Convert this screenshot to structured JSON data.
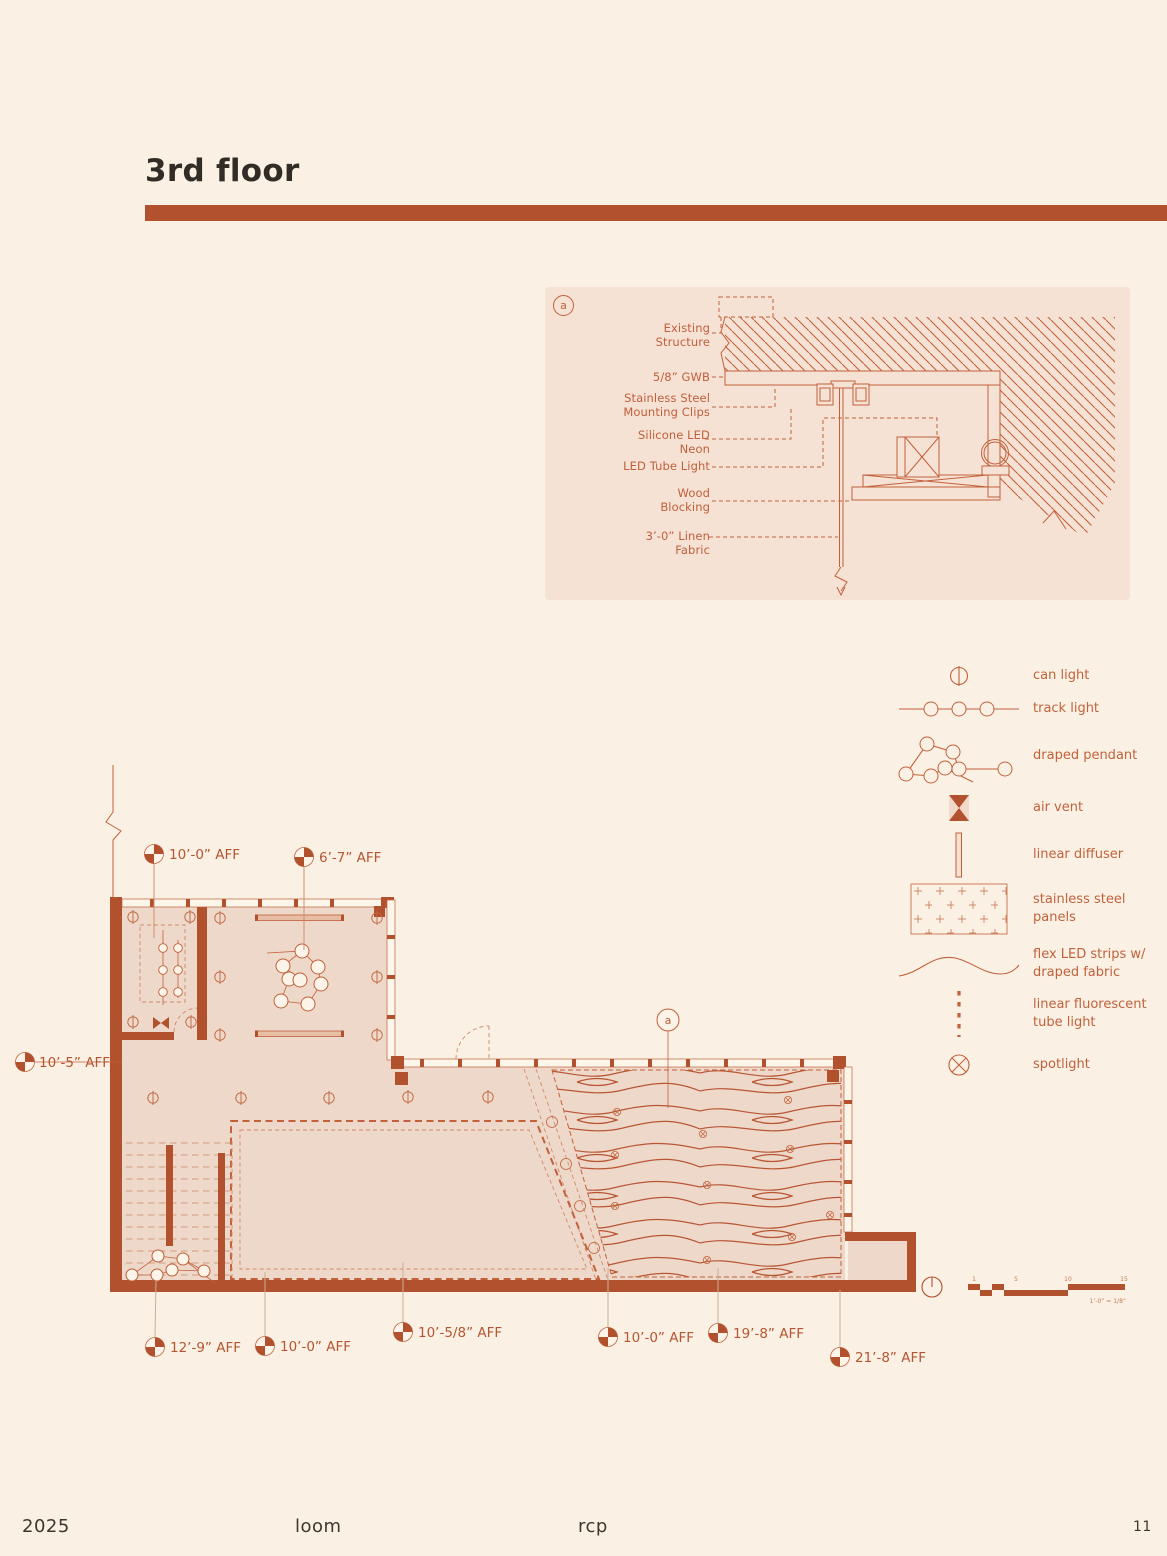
{
  "page": {
    "title": "3rd floor",
    "footer": {
      "year": "2025",
      "project": "loom",
      "sheet": "rcp",
      "page_number": "11"
    }
  },
  "colors": {
    "accent": "#b2512e",
    "line": "#c2613c",
    "page_bg": "#faf1e4",
    "detail_bg": "#f6e2d4",
    "plan_fill": "#eed8c9",
    "title_text": "#322c26"
  },
  "detail": {
    "callout": "a",
    "labels": [
      "Existing Structure",
      "5/8” GWB",
      "Stainless Steel Mounting Clips",
      "Silicone LED Neon",
      "LED Tube Light",
      "Wood Blocking",
      "3’-0” Linen Fabric"
    ]
  },
  "legend": {
    "items": [
      {
        "icon": "can-light-icon",
        "label": "can light"
      },
      {
        "icon": "track-light-icon",
        "label": "track light"
      },
      {
        "icon": "draped-pendant-icon",
        "label": "draped pendant"
      },
      {
        "icon": "air-vent-icon",
        "label": "air vent"
      },
      {
        "icon": "linear-diffuser-icon",
        "label": "linear diffuser"
      },
      {
        "icon": "stainless-steel-panels-icon",
        "label": "stainless steel panels"
      },
      {
        "icon": "flex-led-strips-icon",
        "label": "flex LED strips w/ draped fabric"
      },
      {
        "icon": "linear-fluorescent-tube-icon",
        "label": "linear fluorescent tube light"
      },
      {
        "icon": "spotlight-icon",
        "label": "spotlight"
      }
    ]
  },
  "plan": {
    "callout": "a",
    "annotations": [
      {
        "label": "10’-0” AFF"
      },
      {
        "label": "6’-7” AFF"
      },
      {
        "label": "10’-5” AFF"
      },
      {
        "label": "12’-9” AFF"
      },
      {
        "label": "10’-0” AFF"
      },
      {
        "label": "10’-5/8” AFF"
      },
      {
        "label": "10’-0” AFF"
      },
      {
        "label": "19’-8” AFF"
      },
      {
        "label": "21’-8” AFF"
      }
    ]
  },
  "scalebar": {
    "ticks": [
      "1",
      "5",
      "10",
      "15"
    ],
    "note": "1’-0” = 1/8”"
  }
}
